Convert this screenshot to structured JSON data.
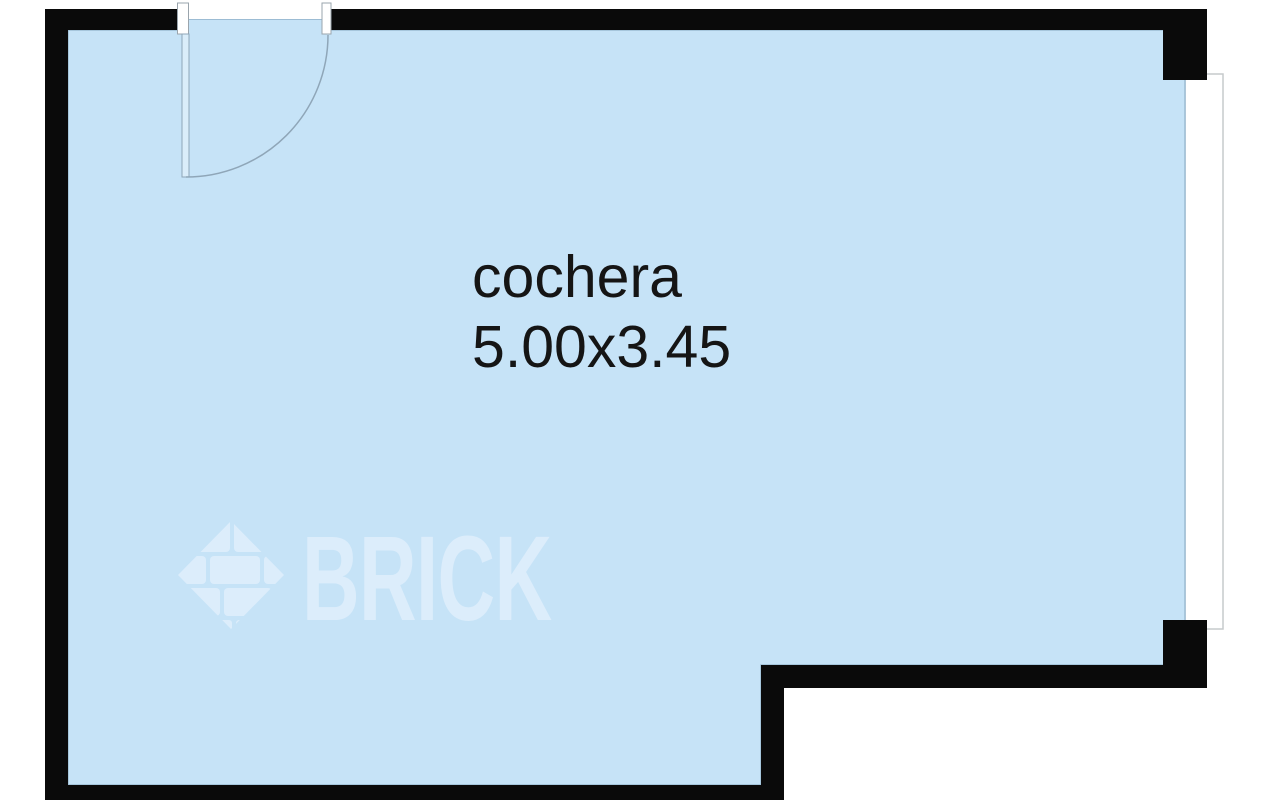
{
  "plan": {
    "room": {
      "label": "cochera",
      "dimensions": "5.00x3.45"
    },
    "watermark": {
      "brand": "BRICK",
      "logo": "brick-diamond-logo"
    },
    "colors": {
      "background": "#ffffff",
      "wall": "#0a0a0a",
      "floor_fill": "#c6e3f7",
      "floor_outline": "#9cbcd4",
      "door_line": "#8fa6b8",
      "window_outline": "#c6cacc",
      "label_text": "#151515",
      "watermark": "#dcedfb"
    }
  }
}
